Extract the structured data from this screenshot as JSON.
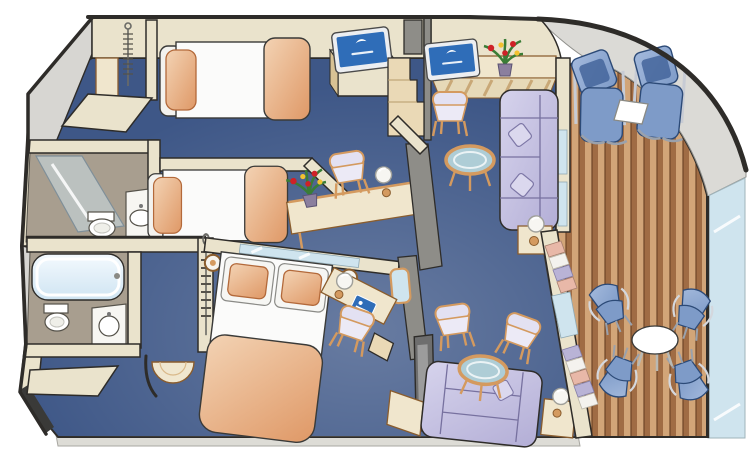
{
  "palette": {
    "background": "#ffffff",
    "outline": "#2e2c29",
    "carpet": "#3e5787",
    "wall_face": "#eae3cc",
    "wall_gray": "#d7d6d2",
    "wall_gray_dark": "#8e8d88",
    "bath_floor": "#a89e8f",
    "wood": "#d49a5f",
    "wood_dark": "#8a5d2e",
    "furniture_cream": "#f0e6cd",
    "step_wood": "#ead9b6",
    "bed_white": "#fbfbfa",
    "peach": "#f3d3b4",
    "peach_dark": "#df9866",
    "sofa_light": "#d6d3ec",
    "sofa_dark": "#b3aed6",
    "sofa_line": "#77719f",
    "chair_blue": "#7e9bc8",
    "chair_blue_light": "#a3b9dc",
    "chair_blue_dark": "#44659b",
    "deck_light": "#d2a578",
    "deck_dark": "#a06c44",
    "hull_gray": "#dbdad6",
    "glass": "#cfe4ee",
    "glass_table": "#aecdd6",
    "tv_screen": "#2f6db8",
    "flower_red": "#cf2127",
    "flower_yellow": "#f2c230",
    "leaf_green": "#3a7d36",
    "curtain_pink": "#e8b8a8",
    "curtain_lav": "#b9b3d6",
    "lamp_white": "#f7f6f2"
  },
  "scene": {
    "kind": "isometric-cruise-ship-suite-floorplan",
    "rooms": [
      "upper-twin-bedroom",
      "middle-twin-bedroom",
      "master-bedroom",
      "upper-bathroom",
      "lower-bathroom-with-tub",
      "sitting-area",
      "living-room",
      "wraparound-teak-balcony"
    ],
    "furniture_counts": {
      "twin_beds": 2,
      "queen_bed": 1,
      "sofas": 2,
      "armchairs": 4,
      "glass_coffee_tables": 2,
      "flat_tvs": 3,
      "desks": 3,
      "wardrobes": 3,
      "sun_loungers": 2,
      "balcony_chairs": 4,
      "balcony_tables": 2,
      "flower_vases": 2,
      "lamps": 6,
      "wall_sconces": 2,
      "bathtub": 1,
      "shower": 1,
      "toilets": 2,
      "sinks": 2
    }
  }
}
